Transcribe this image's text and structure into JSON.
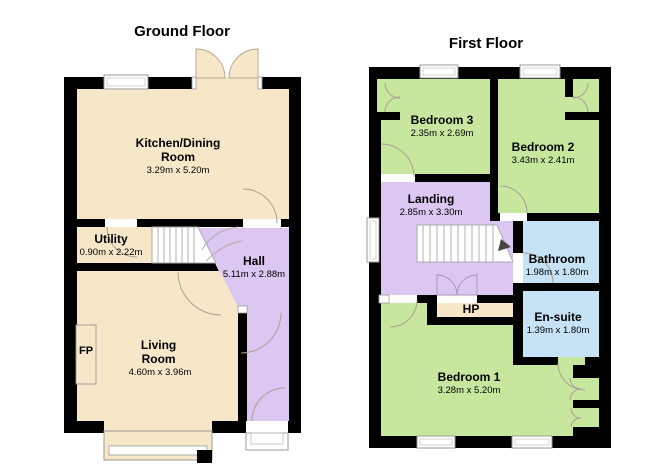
{
  "ground": {
    "title": "Ground Floor",
    "rooms": {
      "kitchen": {
        "name": "Kitchen/Dining Room",
        "dims": "3.29m x 5.20m"
      },
      "utility": {
        "name": "Utility",
        "dims": "0.90m x 2.22m"
      },
      "hall": {
        "name": "Hall",
        "dims": "5.11m x 2.88m"
      },
      "living": {
        "name": "Living Room",
        "dims": "4.60m x 3.96m"
      },
      "fireplace": {
        "abbr": "FP"
      }
    }
  },
  "first": {
    "title": "First Floor",
    "rooms": {
      "bedroom3": {
        "name": "Bedroom 3",
        "dims": "2.35m x 2.69m"
      },
      "bedroom2": {
        "name": "Bedroom 2",
        "dims": "3.43m x 2.41m"
      },
      "landing": {
        "name": "Landing",
        "dims": "2.85m x 3.30m"
      },
      "bathroom": {
        "name": "Bathroom",
        "dims": "1.98m x 1.80m"
      },
      "ensuite": {
        "name": "En-suite",
        "dims": "1.39m x 1.80m"
      },
      "hotpress": {
        "abbr": "HP"
      },
      "bedroom1": {
        "name": "Bedroom 1",
        "dims": "3.28m x 5.20m"
      }
    }
  },
  "colors": {
    "room_cream": "#f7e7c9",
    "room_purple": "#dcc7f2",
    "room_green": "#c8e79e",
    "room_blue": "#c5e3f5",
    "wall": "#000000",
    "door_arc": "#a9a094",
    "window_frame": "#999999"
  }
}
